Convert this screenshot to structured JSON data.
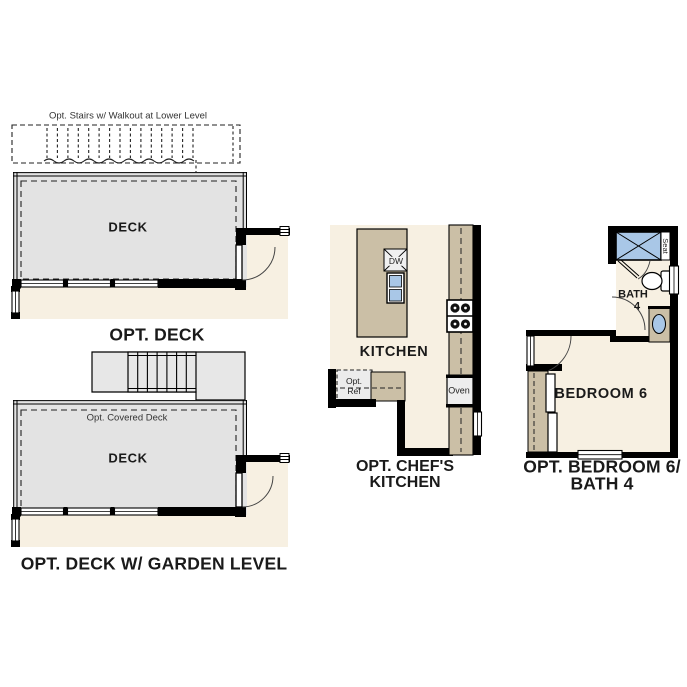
{
  "title": "Floor plan options",
  "colors": {
    "floor_beige": "#f7f0e2",
    "deck_gray": "#e3e3e3",
    "stair_gray": "#e7e7e7",
    "counter_tan": "#cbbfa6",
    "fixture_blue": "#a9c7e7",
    "ref_gray": "#ececec",
    "wall_black": "#000000",
    "note_text": "#333333",
    "label_text": "#1a1a1a"
  },
  "panels": {
    "opt_deck": {
      "stairs_note": "Opt. Stairs w/ Walkout at Lower Level",
      "room_label": "DECK",
      "caption": "OPT. DECK"
    },
    "opt_deck_garden": {
      "covered_note": "Opt. Covered Deck",
      "room_label": "DECK",
      "caption": "OPT. DECK W/ GARDEN LEVEL"
    },
    "opt_chefs_kitchen": {
      "room_label": "KITCHEN",
      "caption_line1": "OPT. CHEF'S",
      "caption_line2": "KITCHEN",
      "dishwasher_label": "DW",
      "refrigerator_line1": "Opt.",
      "refrigerator_line2": "Ref",
      "oven_label": "Oven"
    },
    "opt_bedroom6_bath4": {
      "room_label": "BEDROOM 6",
      "bath_label_line1": "BATH",
      "bath_label_line2": "4",
      "shower_seat_label": "Seat",
      "caption_line1": "OPT. BEDROOM 6/",
      "caption_line2": "BATH 4"
    }
  }
}
